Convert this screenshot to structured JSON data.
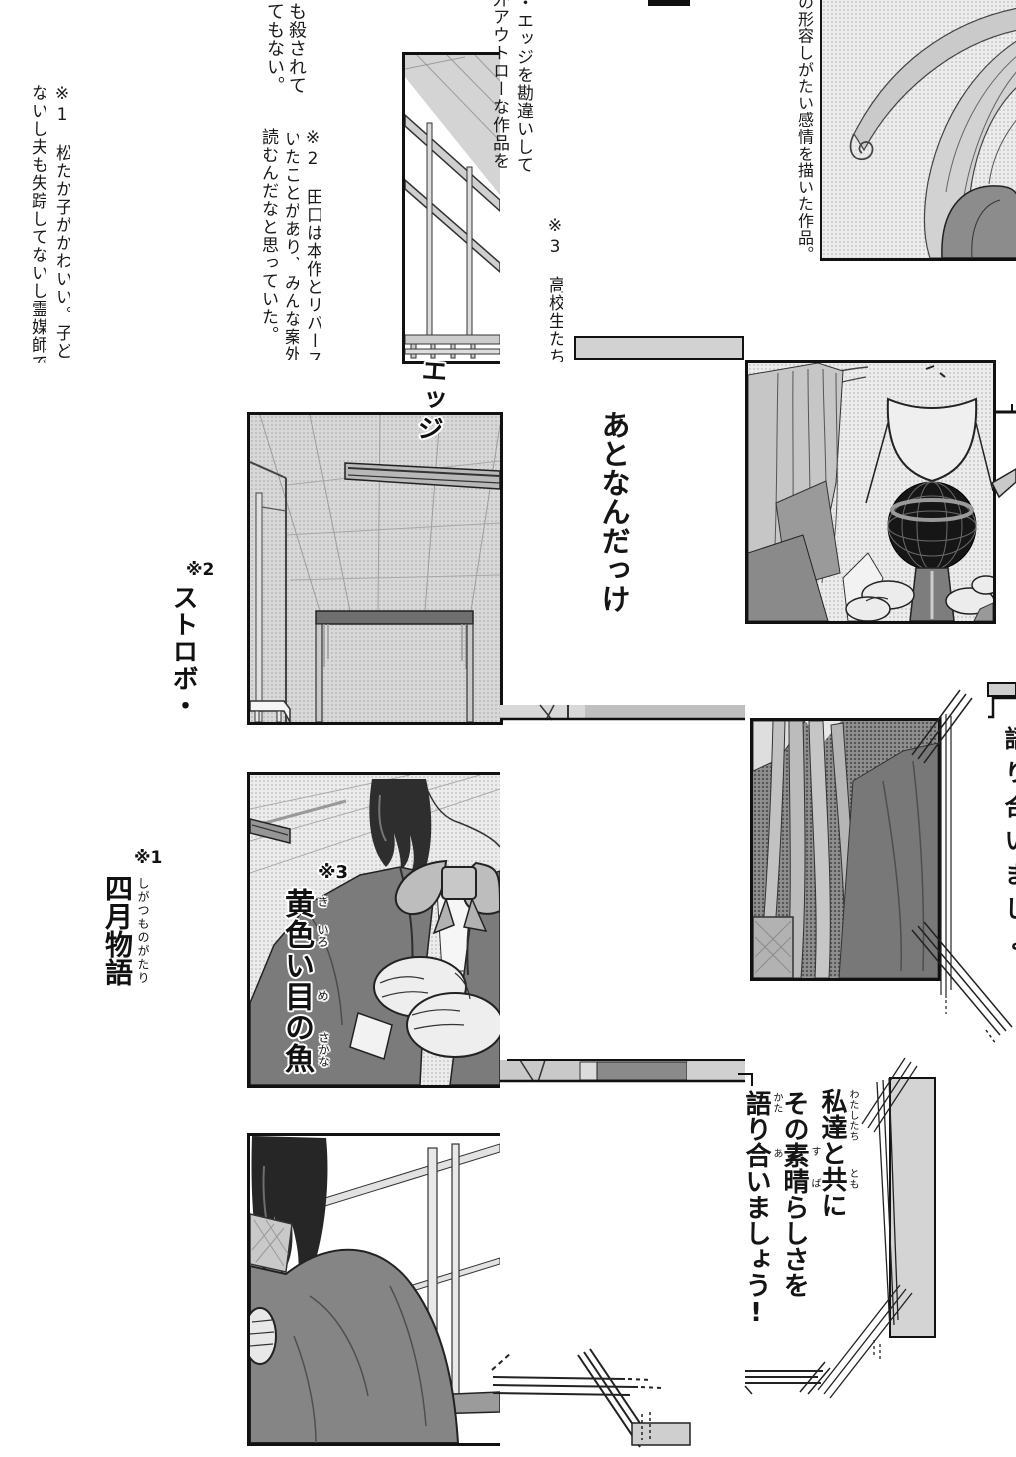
{
  "page": {
    "bg": "#ffffff",
    "ink": "#1a1a1a",
    "tone_light": "#ececec",
    "tone_mid": "#d8d8d8",
    "tone_dark": "#8f8f8f"
  },
  "annotations": {
    "cutoff_top_left": {
      "cols": [
        "も殺されて",
        "てもない。"
      ]
    },
    "footnote2": {
      "cols": [
        "※2　田口は本作とリバース",
        "いたことがあり、みんな案外",
        "読むんだなと思っていた。"
      ]
    },
    "footnote1": {
      "cols": [
        "※1　松たか子がかわいい。子ども",
        "ないし夫も失踪してないし霊媒師で"
      ]
    },
    "footnote3": {
      "cols": [
        "※3　高校生たちの",
        "・エッジを勘違いして",
        "外アウトローな作品を"
      ]
    },
    "work_note": {
      "col": "の形容しがたい感情を描いた作品。"
    }
  },
  "titles": {
    "strobe_edge": {
      "mark": "※2",
      "text": "ストロボ・",
      "overlay": "エッジ"
    },
    "april_story": {
      "mark": "※1",
      "text": "四月物語",
      "furigana": "しがつものがたり"
    },
    "yellow_fish": {
      "mark": "※3",
      "text": "黄色い目の魚",
      "furigana": {
        "ki": "き",
        "iro": "いろ",
        "me": "め",
        "sakana": "さかな"
      }
    }
  },
  "speech": {
    "recall": "あとなんだっけ",
    "invite": {
      "cols": [
        "私達と共に",
        "その素晴らしさを",
        "語り合いましょう!"
      ],
      "furigana": {
        "watashitachi": "わたしたち",
        "tomo": "とも",
        "su": "す",
        "ba": "ば",
        "kata": "かた",
        "a": "あ"
      }
    },
    "edge_clipped": "語り合いましょ"
  }
}
